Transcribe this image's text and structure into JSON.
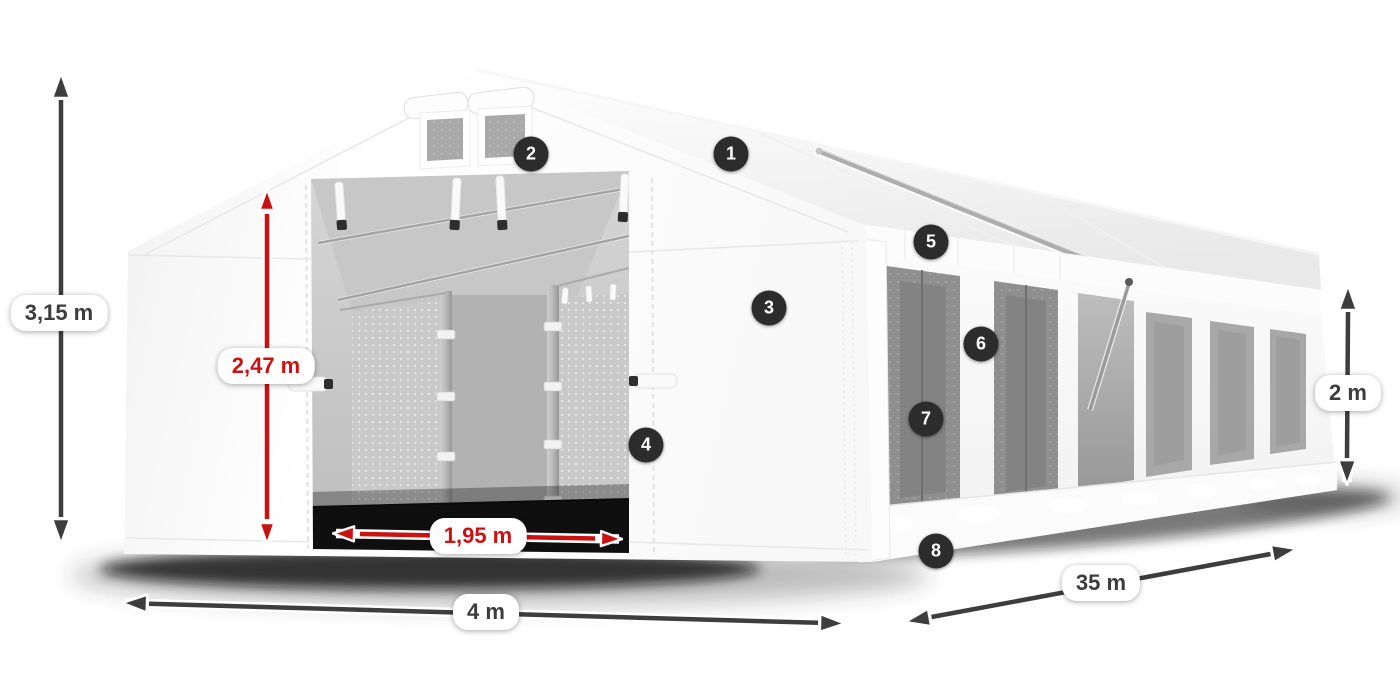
{
  "dimensions": {
    "overall_height": {
      "value": "3,15 m",
      "style": "dark"
    },
    "door_height": {
      "value": "2,47 m",
      "style": "red"
    },
    "door_width": {
      "value": "1,95 m",
      "style": "red"
    },
    "front_width": {
      "value": "4 m",
      "style": "dark"
    },
    "side_length": {
      "value": "35 m",
      "style": "dark"
    },
    "side_wall_height": {
      "value": "2 m",
      "style": "dark"
    }
  },
  "callouts": [
    {
      "label": "1"
    },
    {
      "label": "2"
    },
    {
      "label": "3"
    },
    {
      "label": "4"
    },
    {
      "label": "5"
    },
    {
      "label": "6"
    },
    {
      "label": "7"
    },
    {
      "label": "8"
    }
  ],
  "colors": {
    "accent_red": "#cc1111",
    "arrow_gray": "#3d3d3d",
    "badge_bg": "#2c2c2c",
    "badge_text": "#ffffff",
    "label_bg": "#ffffff",
    "label_text": "#3c3c3c"
  }
}
